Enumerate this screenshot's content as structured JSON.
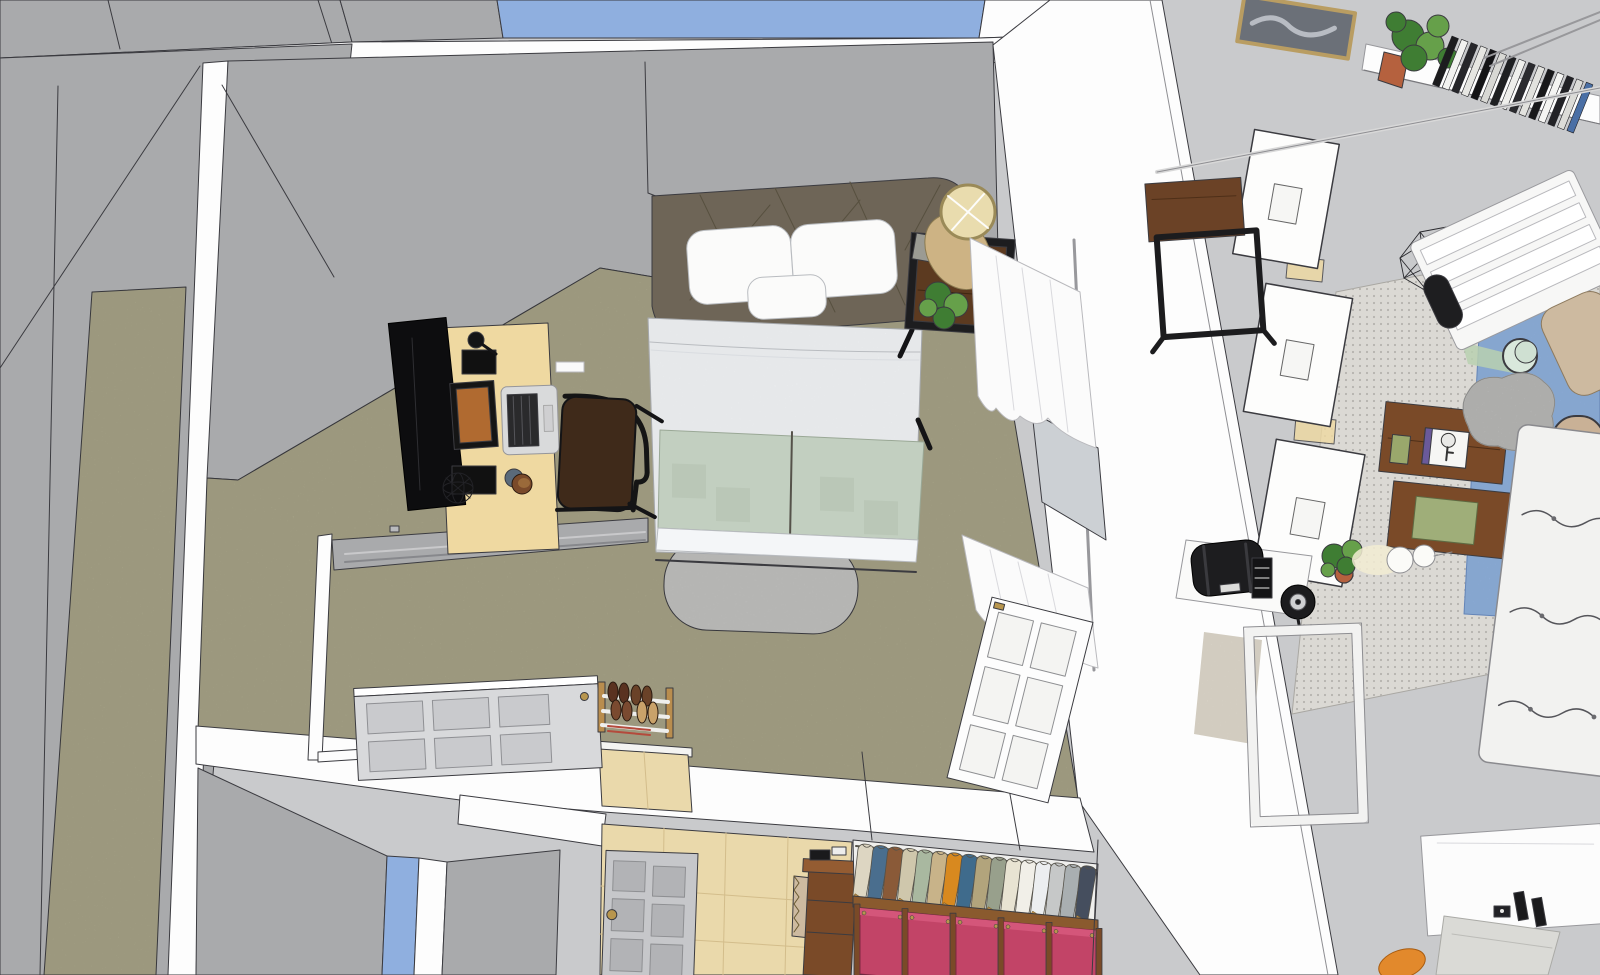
{
  "meta": {
    "app_label": "3d-room-model-viewport",
    "view_label": "top-down-birdseye-render",
    "canvas": {
      "width": 1600,
      "height": 975
    }
  },
  "palette": {
    "background": "#c9cacc",
    "edge": "#3b3b40",
    "wall_face": "#a9aaac",
    "wall_face_dark": "#9fa0a2",
    "wall_top_white": "#fdfdfd",
    "window_glass": "#8fafdf",
    "carpet_olive": "#b4b092",
    "floor_tile": "#ead9ab",
    "tile_line": "#d3bd8b",
    "rug_dotted_gray": "#dbd9d4",
    "rug_blue": "#93b5e2",
    "rug_beige": "#e5dfd2",
    "foot_rug_gray": "#cbcbc9",
    "headboard_taupe": "#6e6557",
    "duvet_white": "#f4f6f8",
    "blanket_sage": "#c2cfc0",
    "pillow_white": "#fbfbfa",
    "desk_wood": "#efd9a1",
    "dark_wood": "#6b4226",
    "nightstand_wood": "#5c3a20",
    "chest_wood": "#7a4a28",
    "metal_black": "#1d1d1f",
    "door_white": "#fdfdfd",
    "door_gray": "#c6c7ca",
    "door_panel_gray": "#b2b3b6",
    "brass": "#b8964e",
    "curtain_white": "#fbfbfb",
    "plant_green": "#3f7d33",
    "plant_green_light": "#66a04a",
    "pot_terracotta": "#b5613e",
    "lamp_gold": "#cdb384",
    "couch_white": "#f2f2f0",
    "pouf_gray": "#d4d4d2",
    "drawer_pink": "#c24467",
    "drawer_pink_light": "#d4567a",
    "hanger_wood": "#b98d4e",
    "shelf_wood": "#8a5a2e",
    "luggage_black": "#1d1d1f",
    "window_inset_gray": "#ccd0d4",
    "cushion_tan": "#cdbaa0",
    "towel_gray": "#dadad6",
    "orange_item": "#e2892c"
  },
  "closet": {
    "garment_colors": [
      "#ddd6c2",
      "#4a6e8e",
      "#8a5a38",
      "#cfc7ac",
      "#a9b8a0",
      "#c8b389",
      "#d8891f",
      "#3f6b8c",
      "#b2a47c",
      "#98a08c",
      "#e8e3d2",
      "#f1efe8",
      "#eceef0",
      "#c6c8c8",
      "#a9afb1",
      "#454e5e"
    ],
    "drawer_count": 5
  },
  "shelf": {
    "book_colors": [
      "#1c1c1e",
      "#f2f2f0",
      "#26262a",
      "#e6e6e2",
      "#141416",
      "#d8d8d4",
      "#1f2022",
      "#efefec",
      "#2b2b2f",
      "#e2e2de",
      "#18181a",
      "#f4f4f2",
      "#222226",
      "#dcdcd8",
      "#4a6fa5"
    ]
  },
  "objects": [
    {
      "id": "bed",
      "label": "double bed with tufted headboard, pillows, white duvet and sage runner"
    },
    {
      "id": "foot-rug",
      "label": "gray oval rug at foot of bed"
    },
    {
      "id": "nightstand",
      "label": "dark wood nightstand with plant and gold drum lamp"
    },
    {
      "id": "desk",
      "label": "light wood desk with TV, monitor, laptop and speakers"
    },
    {
      "id": "desk-chair",
      "label": "dark brown desk chair"
    },
    {
      "id": "shoe-rack",
      "label": "wooden shoe rack with shoes"
    },
    {
      "id": "open-door-white",
      "label": "white six-panel door open into bedroom"
    },
    {
      "id": "flat-door",
      "label": "light gray six-panel door lying open"
    },
    {
      "id": "hall-door",
      "label": "gray six-panel hallway door"
    },
    {
      "id": "curtains",
      "label": "white window curtains"
    },
    {
      "id": "closet",
      "label": "closet with hanging shirts and pink drawer modules"
    },
    {
      "id": "hall-chest",
      "label": "small wooden chest in hallway"
    },
    {
      "id": "leaning-frames",
      "label": "three white picture frames leaning on wall"
    },
    {
      "id": "wall-picture",
      "label": "framed picture"
    },
    {
      "id": "book-shelf",
      "label": "white shelf with potted plant and books"
    },
    {
      "id": "side-table-dark",
      "label": "dark wood side table with black frame"
    },
    {
      "id": "wire-pendant",
      "label": "geometric wireframe pendant lamp"
    },
    {
      "id": "slat-bench",
      "label": "white slatted bench frame with tan cushion"
    },
    {
      "id": "office-chair",
      "label": "tan office chair (partial)"
    },
    {
      "id": "dotted-rug",
      "label": "light dotted area rug"
    },
    {
      "id": "blue-rug",
      "label": "blue rug with cup"
    },
    {
      "id": "dresser-pair",
      "label": "two wooden dressers with decor items"
    },
    {
      "id": "pouf",
      "label": "gray fluffy pouf"
    },
    {
      "id": "couch",
      "label": "white tufted couch"
    },
    {
      "id": "small-plant",
      "label": "small potted plant"
    },
    {
      "id": "white-lamp",
      "label": "white table lamp"
    },
    {
      "id": "luggage-table",
      "label": "white table with black duffel bag"
    },
    {
      "id": "desk-fan",
      "label": "black desk fan"
    },
    {
      "id": "door-frame-lying",
      "label": "white door frame lying on floor"
    },
    {
      "id": "white-panel",
      "label": "white panel with clamps, pipe and towel"
    }
  ]
}
